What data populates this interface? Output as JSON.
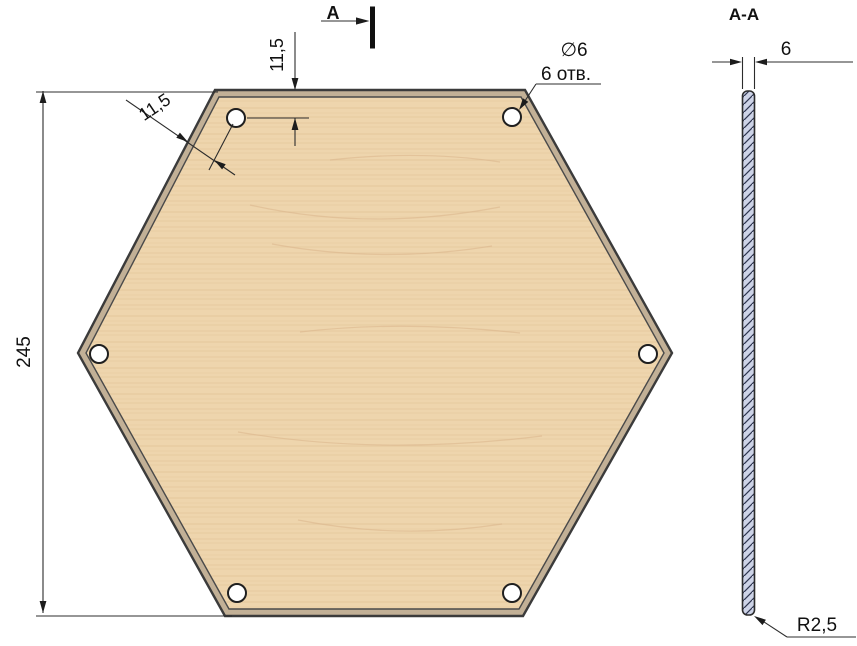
{
  "drawing": {
    "labels": {
      "section_arrow_letter": "A",
      "section_view_title": "A-A",
      "overall_height": "245",
      "hole_offset_top": "11,5",
      "hole_offset_edge": "11,5",
      "hole_diameter": "∅6",
      "hole_count_note": "6 отв.",
      "thickness": "6",
      "edge_radius": "R2,5"
    },
    "colors": {
      "background": "#ffffff",
      "wood_base": "#eed5ad",
      "wood_grain": "#dcba8e",
      "edge_band": "#c2b096",
      "outline": "#3b3b3b",
      "dim_line": "#2c2c2c",
      "section_fill": "#cdd3e7",
      "section_hatch": "#2e3550",
      "hole_fill": "#ffffff"
    },
    "geometry": {
      "hexagon_outer": "215,90 525,90 672,353 523,616 225,616 78,353",
      "hexagon_inner": "219,97 521,97 664,353 519,609 229,609 86,353",
      "hole_radius": "9",
      "holes": [
        {
          "cx": "236",
          "cy": "118"
        },
        {
          "cx": "512",
          "cy": "117"
        },
        {
          "cx": "99",
          "cy": "354"
        },
        {
          "cx": "648",
          "cy": "354"
        },
        {
          "cx": "237",
          "cy": "593"
        },
        {
          "cx": "512",
          "cy": "593"
        }
      ],
      "section_strip": {
        "x": "742.5",
        "y": "91",
        "width": "12",
        "height": "524"
      }
    }
  }
}
